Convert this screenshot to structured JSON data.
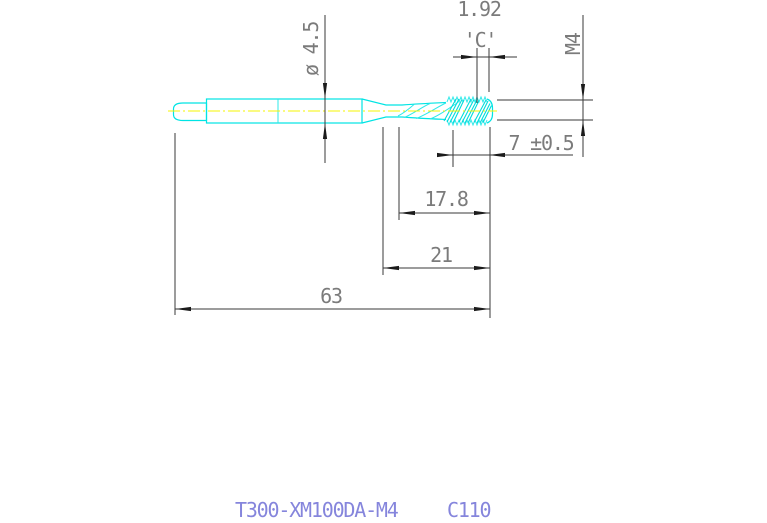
{
  "drawing": {
    "type": "engineering-drawing-machine-tap",
    "colors": {
      "geometry_line": "#00e4e4",
      "centerline": "#f4f400",
      "dimension_line": "#3a3a3a",
      "dimension_text": "#7b7b7b",
      "title_text": "#8585dc",
      "background": "#ffffff"
    },
    "dimensions": {
      "tip_width": "1.92",
      "chamfer_label": "'C'",
      "thread_spec": "M4",
      "shank_diameter": "ø  4.5",
      "thread_length": "7 ±0.5",
      "flute_length": "17.8",
      "front_length": "21",
      "overall_length": "63"
    },
    "title_block": {
      "part_number": "T300-XM100DA-M4",
      "code": "C110"
    }
  }
}
